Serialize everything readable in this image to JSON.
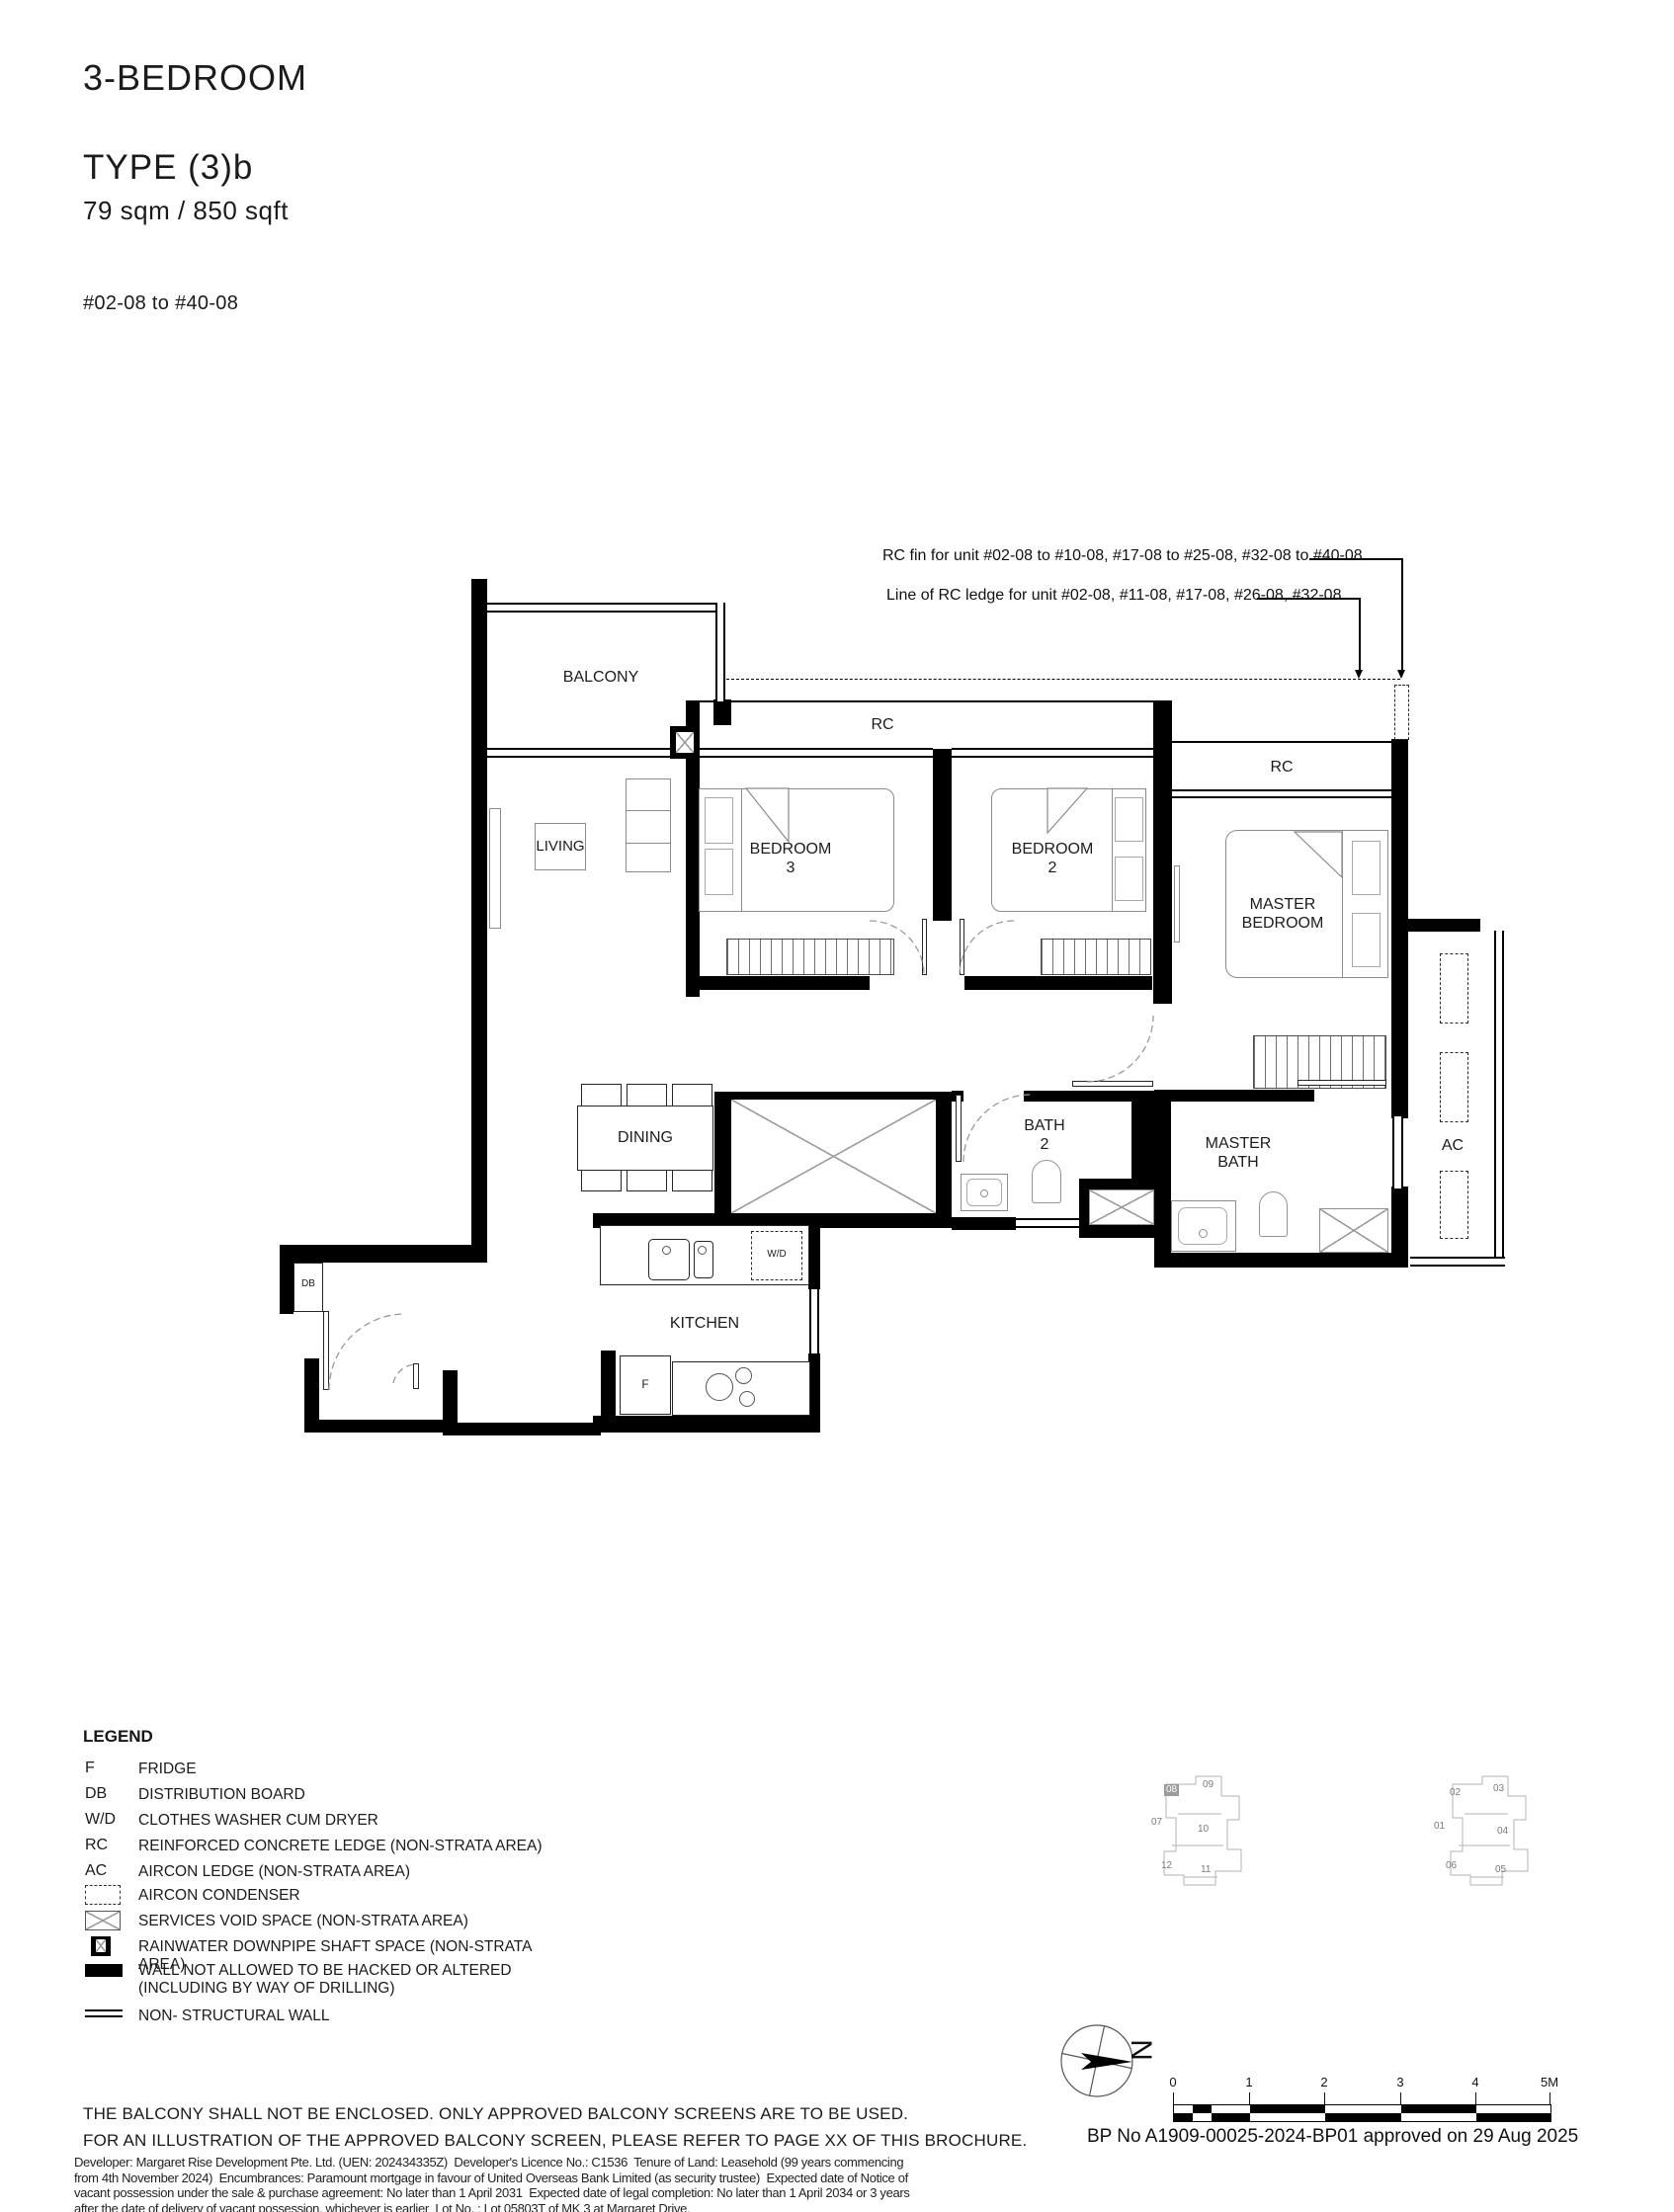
{
  "header": {
    "category": "3-BEDROOM",
    "type_label": "TYPE (3)b",
    "area": "79 sqm / 850 sqft",
    "unit_range": "#02-08 to #40-08"
  },
  "annotations": {
    "rc_fin": "RC fin for unit #02-08 to #10-08, #17-08 to #25-08, #32-08 to #40-08",
    "rc_ledge": "Line of RC ledge for unit #02-08, #11-08, #17-08, #26-08, #32-08"
  },
  "rooms": {
    "balcony": "BALCONY",
    "living": "LIVING",
    "bedroom3_line1": "BEDROOM",
    "bedroom3_line2": "3",
    "bedroom2_line1": "BEDROOM",
    "bedroom2_line2": "2",
    "master_bedroom_line1": "MASTER",
    "master_bedroom_line2": "BEDROOM",
    "dining": "DINING",
    "bath2_line1": "BATH",
    "bath2_line2": "2",
    "master_bath_line1": "MASTER",
    "master_bath_line2": "BATH",
    "kitchen": "KITCHEN",
    "rc_left": "RC",
    "rc_right": "RC",
    "ac": "AC",
    "db": "DB",
    "wd": "W/D",
    "fridge": "F"
  },
  "legend": {
    "title": "LEGEND",
    "items": [
      {
        "symbol": "F",
        "label": "FRIDGE"
      },
      {
        "symbol": "DB",
        "label": "DISTRIBUTION BOARD"
      },
      {
        "symbol": "W/D",
        "label": "CLOTHES WASHER CUM DRYER"
      },
      {
        "symbol": "RC",
        "label": "REINFORCED CONCRETE LEDGE (NON-STRATA AREA)"
      },
      {
        "symbol": "AC",
        "label": "AIRCON LEDGE (NON-STRATA AREA)"
      },
      {
        "symbol": "aircon-condenser-symbol",
        "label": "AIRCON CONDENSER"
      },
      {
        "symbol": "services-void-symbol",
        "label": "SERVICES VOID SPACE (NON-STRATA AREA)"
      },
      {
        "symbol": "rainwater-downpipe-symbol",
        "label": "RAINWATER DOWNPIPE SHAFT SPACE (NON-STRATA AREA)"
      },
      {
        "symbol": "wall-symbol",
        "label": "WALL NOT ALLOWED TO BE HACKED OR ALTERED (INCLUDING BY WAY OF DRILLING)"
      },
      {
        "symbol": "non-structural-wall-symbol",
        "label": "NON- STRUCTURAL WALL"
      }
    ]
  },
  "keyplan": {
    "highlighted_unit": "08",
    "left_units": [
      "08",
      "09",
      "07",
      "10",
      "12",
      "11"
    ],
    "right_units": [
      "02",
      "03",
      "01",
      "04",
      "06",
      "05"
    ]
  },
  "compass": {
    "north_label": "N"
  },
  "scalebar": {
    "ticks": [
      "0",
      "1",
      "2",
      "3",
      "4",
      "5M"
    ]
  },
  "footer": {
    "captions": [
      "THE BALCONY SHALL NOT BE ENCLOSED. ONLY APPROVED BALCONY SCREENS ARE TO BE USED.",
      "FOR AN ILLUSTRATION OF THE APPROVED BALCONY SCREEN, PLEASE REFER TO PAGE XX OF THIS BROCHURE."
    ],
    "fine_print_lines": [
      "Developer: Margaret Rise Development Pte. Ltd. (UEN: 202434335Z)  Developer's Licence No.: C1536  Tenure of Land: Leasehold (99 years commencing",
      "from 4th November 2024)  Encumbrances: Paramount mortgage in favour of United Overseas Bank Limited (as security trustee)  Expected date of Notice of",
      "vacant possession under the sale & purchase agreement: No later than 1 April 2031  Expected date of legal completion: No later than 1 April 2034 or 3 years",
      "after the date of delivery of vacant possession, whichever is earlier  Lot No. : Lot 05803T of MK 3 at Margaret Drive."
    ],
    "bp_approval": "BP No A1909-00025-2024-BP01 approved on 29 Aug 2025"
  }
}
